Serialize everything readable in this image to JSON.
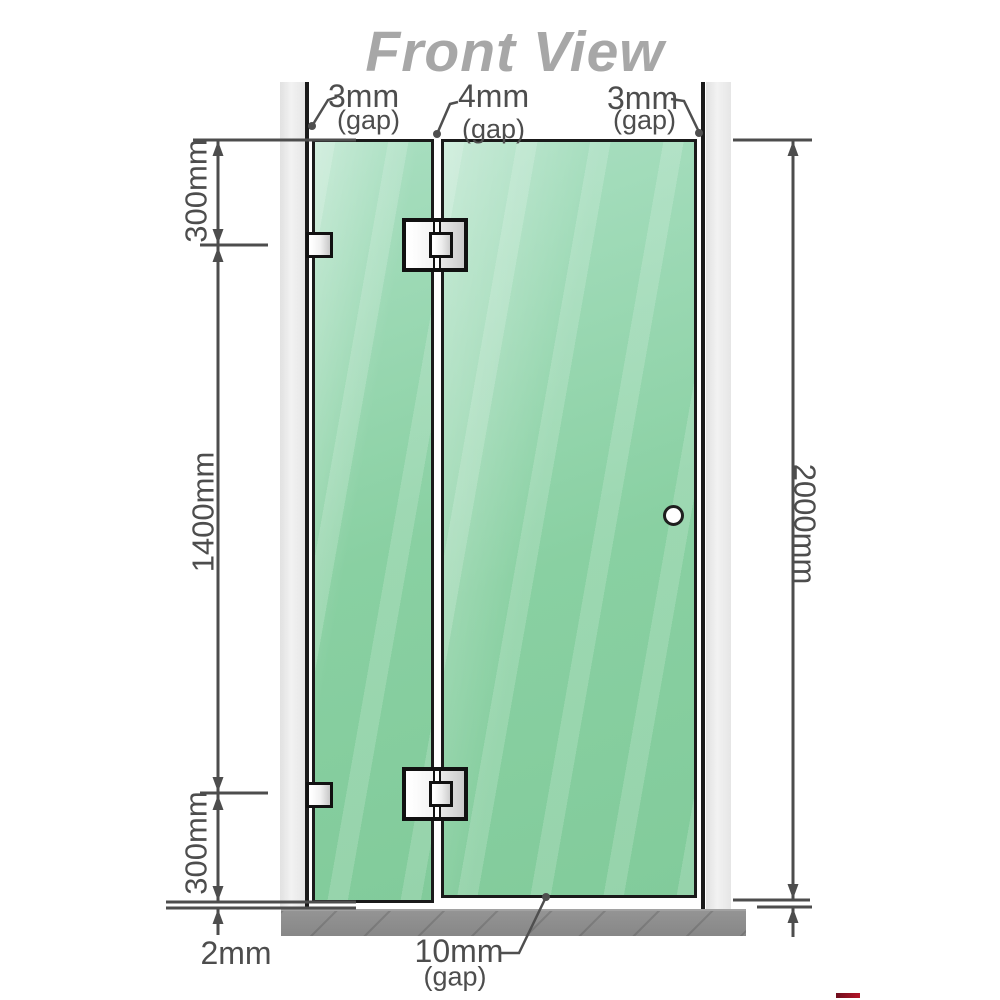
{
  "title": "Front View",
  "gaps": {
    "top": [
      {
        "value": "3mm",
        "suffix": "(gap)"
      },
      {
        "value": "4mm",
        "suffix": "(gap)"
      },
      {
        "value": "3mm",
        "suffix": "(gap)"
      }
    ],
    "bottom": {
      "value": "10mm",
      "suffix": "(gap)"
    }
  },
  "dimensions": {
    "left_top": "300mm",
    "left_middle": "1400mm",
    "left_bottom": "300mm",
    "left_floor_gap": "2mm",
    "right_total": "2000mm"
  },
  "colors": {
    "glass": "#89d0a2",
    "glass-highlight": "#a9dfc1",
    "frame": "#1a1a1a",
    "wall-channel": "#ebebeb",
    "floor": "#878787",
    "dimension": "#4d4d4d",
    "title": "#a7a7a7"
  }
}
